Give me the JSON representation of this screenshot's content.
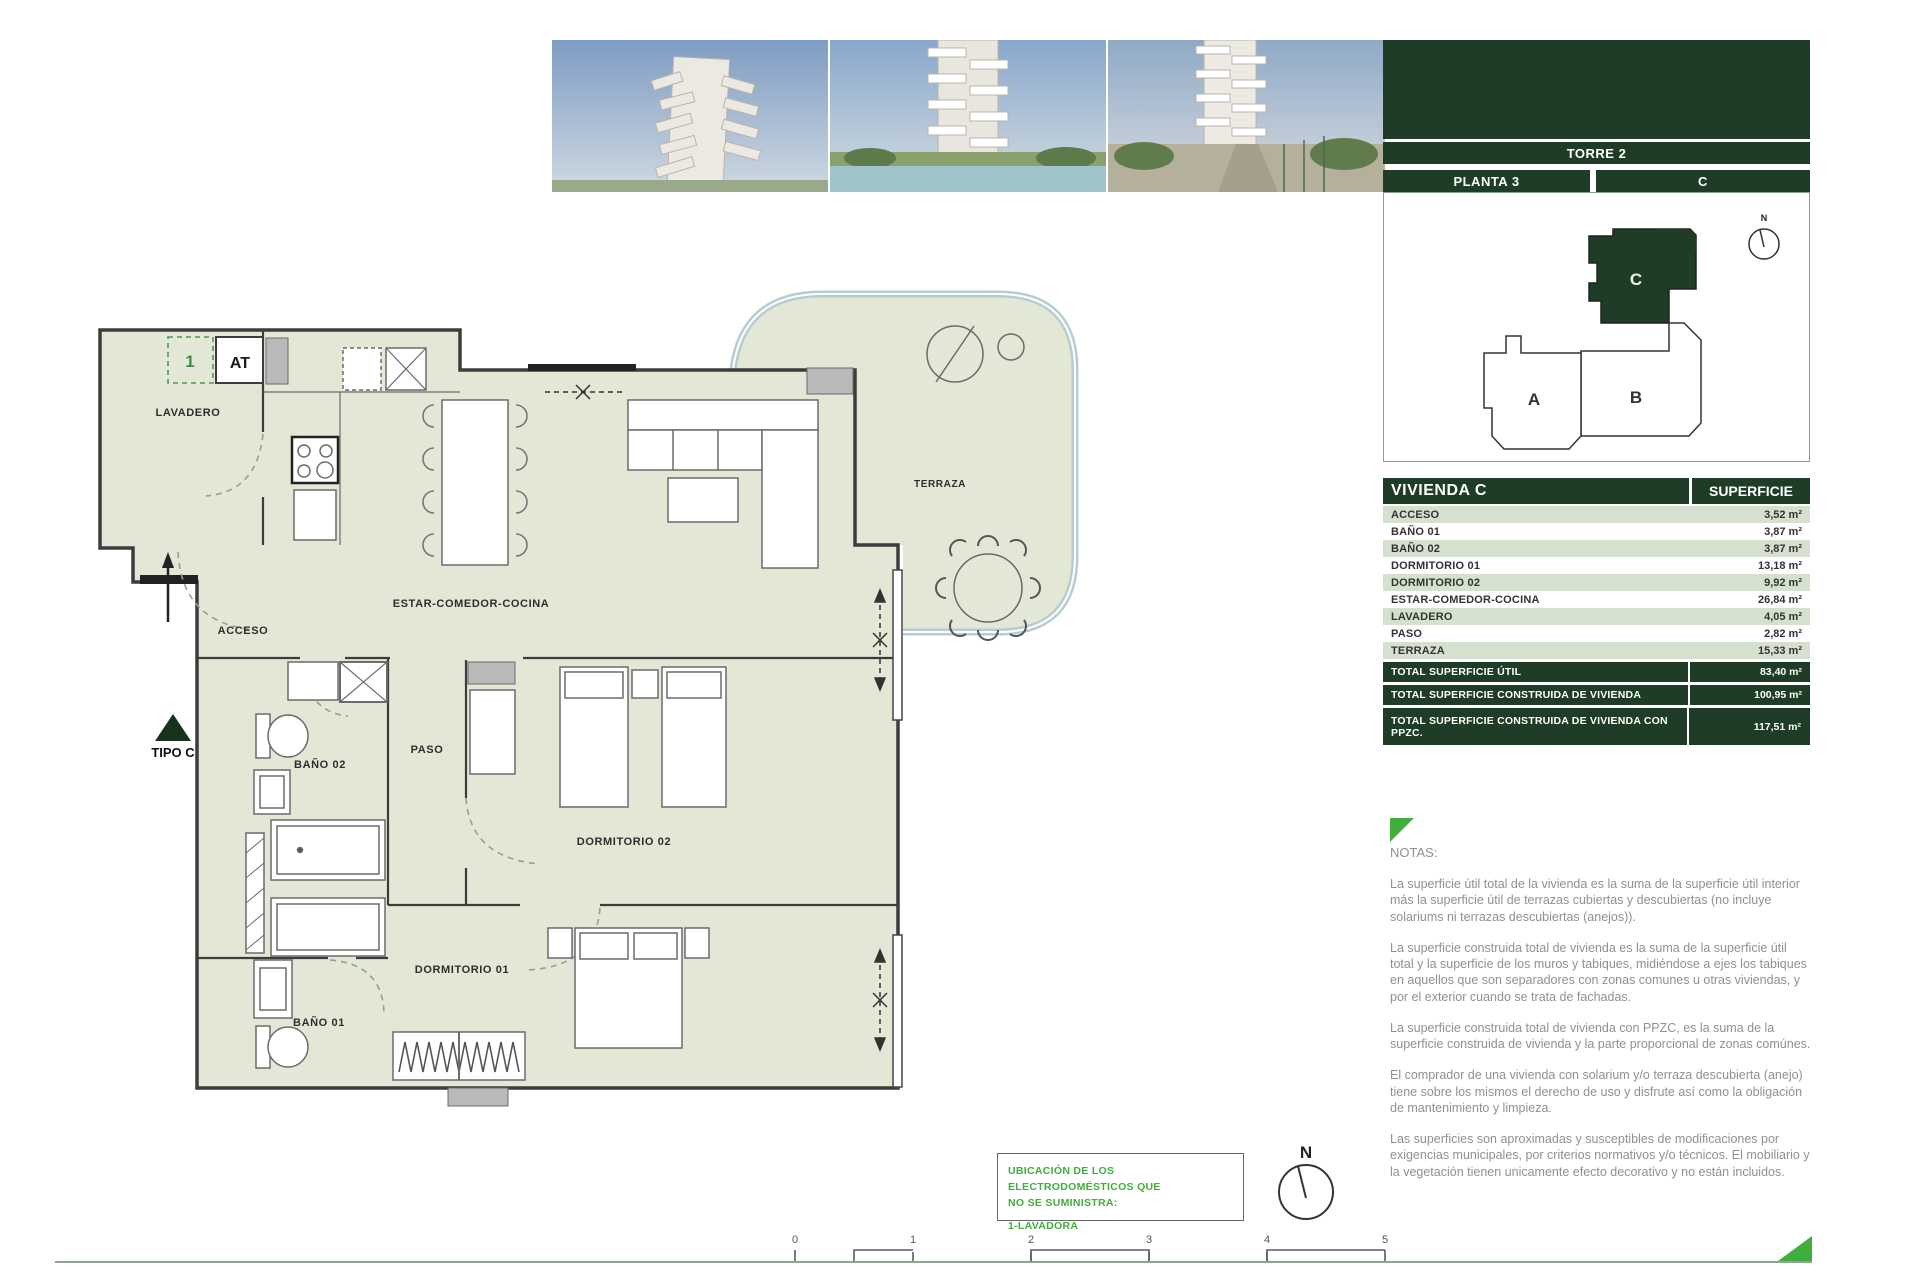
{
  "palette": {
    "dark_green": "#1e3c26",
    "row_green": "#d5e0cf",
    "bright_green": "#3fae3c",
    "floor_fill": "#e3e7d6",
    "glass": "#b7ccd0"
  },
  "sidebar": {
    "torre": "TORRE 2",
    "planta": "PLANTA 3",
    "unit": "C",
    "diagram": {
      "a": "A",
      "b": "B",
      "c": "C",
      "north": "N"
    },
    "table": {
      "header": {
        "left": "VIVIENDA C",
        "right": "SUPERFICIE"
      },
      "rows": [
        {
          "label": "ACCESO",
          "value": "3,52 m²"
        },
        {
          "label": "BAÑO 01",
          "value": "3,87 m²"
        },
        {
          "label": "BAÑO 02",
          "value": "3,87 m²"
        },
        {
          "label": "DORMITORIO 01",
          "value": "13,18 m²"
        },
        {
          "label": "DORMITORIO 02",
          "value": "9,92 m²"
        },
        {
          "label": "ESTAR-COMEDOR-COCINA",
          "value": "26,84 m²"
        },
        {
          "label": "LAVADERO",
          "value": "4,05 m²"
        },
        {
          "label": "PASO",
          "value": "2,82 m²"
        },
        {
          "label": "TERRAZA",
          "value": "15,33 m²"
        }
      ],
      "totals": [
        {
          "label": "TOTAL SUPERFICIE ÚTIL",
          "value": "83,40 m²"
        },
        {
          "label": "TOTAL SUPERFICIE CONSTRUIDA DE VIVIENDA",
          "value": "100,95 m²"
        },
        {
          "label": "TOTAL SUPERFICIE CONSTRUIDA DE VIVIENDA CON PPZC.",
          "value": "117,51 m²"
        }
      ]
    },
    "notes": {
      "title": "NOTAS:",
      "paragraphs": [
        "La superficie útil total de la vivienda es la suma de la superficie útil interior más la superficie útil de terrazas cubiertas y descubiertas (no incluye solariums ni terrazas descubiertas (anejos)).",
        "La superficie construida total de vivienda es la suma de la superficie útil total y la superficie de los muros y tabiques, midiéndose a ejes los tabiques en aquellos que son separadores con zonas comunes u otras viviendas, y por el exterior cuando se trata de fachadas.",
        "La superficie construida total de vivienda con PPZC, es la suma de la superficie construida de vivienda y la parte proporcional de zonas comúnes.",
        "El comprador de una vivienda con solarium y/o terraza descubierta (anejo) tiene sobre los mismos el derecho de uso y disfrute así como la obligación de mantenimiento y limpieza.",
        "Las superficies son aproximadas y susceptibles de modificaciones por exigencias municipales, por criterios normativos y/o técnicos. El mobiliario y la vegetación tienen unicamente efecto decorativo y no están incluidos."
      ]
    }
  },
  "plan": {
    "rooms": {
      "lavadero": "LAVADERO",
      "acceso": "ACCESO",
      "estar": "ESTAR-COMEDOR-COCINA",
      "paso": "PASO",
      "bano02": "BAÑO 02",
      "bano01": "BAÑO 01",
      "dorm01": "DORMITORIO 01",
      "dorm02": "DORMITORIO 02",
      "terraza": "TERRAZA"
    },
    "tipo": "TIPO C",
    "marker1": "1",
    "markerAT": "AT",
    "north": "N",
    "scale": [
      "0",
      "1",
      "2",
      "3",
      "4",
      "5"
    ],
    "legend": {
      "line1": "UBICACIÓN DE LOS ELECTRODOMÉSTICOS QUE",
      "line2": "NO SE SUMINISTRA:",
      "line3": "1-LAVADORA"
    }
  }
}
